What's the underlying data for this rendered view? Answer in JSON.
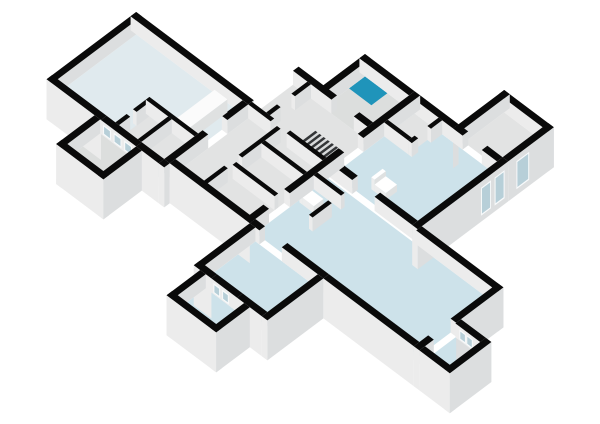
{
  "scene": {
    "kind": "3d-dollhouse-floor-plan",
    "canvas": {
      "width": 600,
      "height": 424
    },
    "background": "#ffffff"
  },
  "colors": {
    "background": "#ffffff",
    "wallTop": "#0a0a0a",
    "faceA": "#ececec",
    "faceB": "#dcdedf",
    "floorHall": "#e0eaee",
    "floorBlue": "#cde2ea",
    "floorGray": "#e2e3e3",
    "floorGray2": "#dcdedd",
    "teal": "#1f94ba",
    "glass": "#b7cfd8",
    "glassFrame": "#f8fafb",
    "counterTop": "#fbfbfb",
    "fixture": "#ffffff",
    "boxFaceA": "#eceded",
    "boxFaceB": "#dfe1e1",
    "stairBase": "#d8dadb",
    "stairStep": "#333537"
  },
  "projection": {
    "ax": 0.8,
    "ay": 0.6,
    "ox": 5,
    "oy": 10,
    "floor_z": 26,
    "wall_z": 40
  },
  "glass_z": {
    "e": [
      6,
      34
    ],
    "i": [
      27,
      37
    ]
  },
  "floors": [
    {
      "n": "floor-great-hall",
      "a": [
        -58,
        40
      ],
      "b": [
        124,
        257
      ],
      "c": "floorHall"
    },
    {
      "n": "floor-hall-storage",
      "a": [
        -58,
        -20
      ],
      "b": [
        200,
        257
      ],
      "c": "floorGray"
    },
    {
      "n": "floor-porch-left",
      "a": [
        -106,
        -65
      ],
      "b": [
        184,
        229
      ],
      "c": "floorGray2"
    },
    {
      "n": "floor-center-corridor",
      "a": [
        -51,
        96
      ],
      "b": [
        264,
        357
      ],
      "c": "floorGray"
    },
    {
      "n": "floor-bathroom",
      "a": [
        96,
        148
      ],
      "b": [
        302,
        357
      ],
      "c": "floorGray2"
    },
    {
      "n": "floor-shower-tray",
      "a": [
        128,
        148
      ],
      "b": [
        302,
        330
      ],
      "c": "teal"
    },
    {
      "n": "floor-room-right-mid",
      "a": [
        47,
        148
      ],
      "b": [
        364,
        467
      ],
      "c": "floorBlue"
    },
    {
      "n": "floor-right-store",
      "a": [
        114,
        148
      ],
      "b": [
        364,
        394
      ],
      "c": "floorGray"
    },
    {
      "n": "floor-room-top-right",
      "a": [
        155,
        205
      ],
      "b": [
        419,
        467
      ],
      "c": "floorGray"
    },
    {
      "n": "floor-room-bot-right",
      "a": [
        -51,
        40
      ],
      "b": [
        364,
        569
      ],
      "c": "floorBlue"
    },
    {
      "n": "floor-porch-right",
      "a": [
        -51,
        -13
      ],
      "b": [
        576,
        607
      ],
      "c": "floorBlue"
    },
    {
      "n": "floor-room-bot-left",
      "a": [
        -121,
        -58
      ],
      "b": [
        371,
        449
      ],
      "c": "floorBlue"
    },
    {
      "n": "floor-porch-west",
      "a": [
        -163,
        -128
      ],
      "b": [
        379,
        427
      ],
      "c": "floorBlue"
    }
  ],
  "walls": [
    {
      "n": "wall-hall-nw",
      "a": [
        -65,
        47
      ],
      "b": [
        117,
        124
      ],
      "fa": "g",
      "fb": "f"
    },
    {
      "n": "wall-hall-ne",
      "a": [
        40,
        47
      ],
      "b": [
        117,
        264
      ],
      "fa": "f",
      "fb": "f"
    },
    {
      "n": "wall-hall-sw-1",
      "a": [
        -65,
        -58
      ],
      "b": [
        117,
        185
      ],
      "fa": "g",
      "fb": "f"
    },
    {
      "n": "wall-hall-sw-glazed",
      "a": [
        -65,
        -58
      ],
      "b": [
        185,
        229
      ],
      "fa": "f",
      "fb": "f",
      "glass": {
        "face": "A",
        "z": "i",
        "spans": [
          [
            0.06,
            0.28
          ],
          [
            0.36,
            0.58
          ],
          [
            0.66,
            0.88
          ]
        ]
      }
    },
    {
      "n": "wall-hall-sw-2",
      "a": [
        -65,
        -58
      ],
      "b": [
        229,
        257
      ],
      "fa": "g",
      "fb": "f"
    },
    {
      "n": "wall-hall-se-1",
      "a": [
        -58,
        -10
      ],
      "b": [
        257,
        264
      ],
      "fa": "f",
      "fb": "f"
    },
    {
      "n": "wall-hall-se-2",
      "a": [
        14,
        40
      ],
      "b": [
        257,
        264
      ],
      "fa": "f",
      "fb": "f"
    },
    {
      "n": "wall-hall-se-corner",
      "a": [
        -65,
        -58
      ],
      "b": [
        257,
        264
      ],
      "fa": "g",
      "fb": "g"
    },
    {
      "n": "wall-porch-left-nw",
      "a": [
        -113,
        -65
      ],
      "b": [
        177,
        184
      ],
      "fa": "g",
      "fb": "f"
    },
    {
      "n": "wall-porch-left-sw",
      "a": [
        -113,
        -106
      ],
      "b": [
        177,
        236
      ],
      "fa": "g",
      "fb": "g"
    },
    {
      "n": "wall-porch-left-se",
      "a": [
        -113,
        -65
      ],
      "b": [
        229,
        236
      ],
      "fa": "g",
      "fb": "g"
    },
    {
      "n": "wall-center-ne-1",
      "a": [
        96,
        103
      ],
      "b": [
        264,
        298
      ],
      "fa": "f",
      "fb": "f"
    },
    {
      "n": "wall-center-ne-2",
      "a": [
        96,
        103
      ],
      "b": [
        298,
        312
      ],
      "fa": "f",
      "fb": "f"
    },
    {
      "n": "wall-center-ne-3",
      "a": [
        96,
        103
      ],
      "b": [
        340,
        357
      ],
      "fa": "f",
      "fb": "f"
    },
    {
      "n": "wall-center-sw",
      "a": [
        -58,
        -51
      ],
      "b": [
        264,
        364
      ],
      "fa": "g",
      "fb": "f"
    },
    {
      "n": "wall-mid-bound-1",
      "a": [
        -58,
        -34
      ],
      "b": [
        357,
        364
      ],
      "fa": "f",
      "fb": "f"
    },
    {
      "n": "wall-mid-bound-2",
      "a": [
        -8,
        60
      ],
      "b": [
        357,
        364
      ],
      "fa": "f",
      "fb": "f"
    },
    {
      "n": "wall-mid-bound-3",
      "a": [
        84,
        155
      ],
      "b": [
        357,
        364
      ],
      "fa": "f",
      "fb": "f"
    },
    {
      "n": "wall-bath-nw",
      "a": [
        96,
        155
      ],
      "b": [
        295,
        302
      ],
      "fa": "f",
      "fb": "f"
    },
    {
      "n": "wall-bath-ne",
      "a": [
        148,
        155
      ],
      "b": [
        295,
        357
      ],
      "fa": "f",
      "fb": "f"
    },
    {
      "n": "wall-rightmid-w-1",
      "a": [
        42,
        49
      ],
      "b": [
        364,
        392
      ],
      "fa": "f",
      "fb": "f"
    },
    {
      "n": "wall-rightmid-w-2",
      "a": [
        42,
        49
      ],
      "b": [
        420,
        467
      ],
      "fa": "f",
      "fb": "f"
    },
    {
      "n": "wall-rightmid-se-glazed",
      "a": [
        42,
        155
      ],
      "b": [
        467,
        474
      ],
      "fa": "g",
      "fb": "g",
      "glass": {
        "face": "B",
        "z": "e",
        "spans": [
          [
            0.7,
            0.81
          ],
          [
            0.85,
            0.96
          ]
        ]
      }
    },
    {
      "n": "wall-rightmid-ne-1",
      "a": [
        148,
        155
      ],
      "b": [
        364,
        412
      ],
      "fa": "f",
      "fb": "g"
    },
    {
      "n": "wall-rightmid-ne-2",
      "a": [
        148,
        155
      ],
      "b": [
        412,
        424
      ],
      "fa": "f",
      "fb": "f"
    },
    {
      "n": "wall-rightmid-ne-3",
      "a": [
        148,
        155
      ],
      "b": [
        448,
        467
      ],
      "fa": "f",
      "fb": "f"
    },
    {
      "n": "wall-right-store-w",
      "a": [
        110,
        114.5
      ],
      "b": [
        364,
        394
      ],
      "fa": "f",
      "fb": "f"
    },
    {
      "n": "wall-right-store-s1",
      "a": [
        110,
        118
      ],
      "b": [
        394,
        398.5
      ],
      "fa": "f",
      "fb": "f"
    },
    {
      "n": "wall-right-store-s2",
      "a": [
        134,
        148
      ],
      "b": [
        394,
        398.5
      ],
      "fa": "f",
      "fb": "f"
    },
    {
      "n": "wall-topright-nw",
      "a": [
        148,
        212
      ],
      "b": [
        412,
        419
      ],
      "fa": "f",
      "fb": "f"
    },
    {
      "n": "wall-topright-ne",
      "a": [
        205,
        212
      ],
      "b": [
        412,
        474
      ],
      "fa": "f",
      "fb": "g"
    },
    {
      "n": "wall-topright-se-glazed",
      "a": [
        155,
        212
      ],
      "b": [
        467,
        474
      ],
      "fa": "f",
      "fb": "g",
      "glass": {
        "face": "B",
        "z": "e",
        "spans": [
          [
            0.18,
            0.46
          ]
        ]
      }
    },
    {
      "n": "wall-botright-e",
      "a": [
        40,
        47
      ],
      "b": [
        474,
        576
      ],
      "fa": "f",
      "fb": "g"
    },
    {
      "n": "wall-botright-w-1",
      "a": [
        -58,
        -51
      ],
      "b": [
        364,
        376
      ],
      "fa": "f",
      "fb": "f"
    },
    {
      "n": "wall-botright-w-2",
      "a": [
        -58,
        -51
      ],
      "b": [
        404,
        456
      ],
      "fa": "f",
      "fb": "f"
    },
    {
      "n": "wall-botright-w-3",
      "a": [
        -58,
        -51
      ],
      "b": [
        456,
        569
      ],
      "fa": "g",
      "fb": "f"
    },
    {
      "n": "wall-botright-s-1",
      "a": [
        -58,
        -40
      ],
      "b": [
        569,
        576
      ],
      "fa": "g",
      "fb": "f"
    },
    {
      "n": "wall-botright-s-2",
      "a": [
        -12,
        47
      ],
      "b": [
        569,
        576
      ],
      "fa": "f",
      "fb": "g"
    },
    {
      "n": "wall-wc-e",
      "a": [
        22,
        26.5
      ],
      "b": [
        364,
        398
      ],
      "fa": "f",
      "fb": "f"
    },
    {
      "n": "wall-wc-s",
      "a": [
        -14,
        10
      ],
      "b": [
        394,
        398.5
      ],
      "fa": "f",
      "fb": "f"
    },
    {
      "n": "wall-porch-right-sw",
      "a": [
        -58,
        -51
      ],
      "b": [
        576,
        614
      ],
      "fa": "g",
      "fb": "g"
    },
    {
      "n": "wall-porch-right-se",
      "a": [
        -58,
        -6
      ],
      "b": [
        607,
        614
      ],
      "fa": "g",
      "fb": "g"
    },
    {
      "n": "wall-porch-right-glazed",
      "a": [
        -13,
        -6
      ],
      "b": [
        576,
        607
      ],
      "fa": "f",
      "fb": "g",
      "glass": {
        "face": "A",
        "z": "i",
        "spans": [
          [
            0.16,
            0.42
          ],
          [
            0.44,
            0.7
          ]
        ]
      }
    },
    {
      "n": "wall-botleft-nw",
      "a": [
        -128,
        -58
      ],
      "b": [
        364,
        371
      ],
      "fa": "g",
      "fb": "f"
    },
    {
      "n": "wall-botleft-w-1",
      "a": [
        -128,
        -121
      ],
      "b": [
        364,
        386
      ],
      "fa": "g",
      "fb": "f"
    },
    {
      "n": "wall-botleft-w-glazed",
      "a": [
        -128,
        -121
      ],
      "b": [
        386,
        418
      ],
      "fa": "f",
      "fb": "f",
      "glass": {
        "face": "A",
        "z": "i",
        "spans": [
          [
            0.08,
            0.34
          ],
          [
            0.42,
            0.68
          ]
        ]
      }
    },
    {
      "n": "wall-botleft-w-2",
      "a": [
        -128,
        -121
      ],
      "b": [
        418,
        449
      ],
      "fa": "g",
      "fb": "f"
    },
    {
      "n": "wall-botleft-se",
      "a": [
        -128,
        -58
      ],
      "b": [
        449,
        456
      ],
      "fa": "g",
      "fb": "g"
    },
    {
      "n": "wall-porch-west-nw",
      "a": [
        -170,
        -128
      ],
      "b": [
        372,
        379
      ],
      "fa": "g",
      "fb": "f"
    },
    {
      "n": "wall-porch-west-sw",
      "a": [
        -170,
        -163
      ],
      "b": [
        372,
        434
      ],
      "fa": "g",
      "fb": "g"
    },
    {
      "n": "wall-porch-west-se",
      "a": [
        -170,
        -128
      ],
      "b": [
        427,
        434
      ],
      "fa": "g",
      "fb": "g"
    },
    {
      "n": "wall-corridor-s1",
      "a": [
        -58,
        -26
      ],
      "b": [
        300,
        304.5
      ],
      "fa": "f",
      "fb": "f"
    },
    {
      "n": "wall-corridor-s2",
      "a": [
        -8,
        40
      ],
      "b": [
        300,
        304.5
      ],
      "fa": "f",
      "fb": "f"
    },
    {
      "n": "wall-center-room-w",
      "a": [
        -20,
        -15.5
      ],
      "b": [
        304.5,
        357
      ],
      "fa": "f",
      "fb": "f"
    },
    {
      "n": "wall-center-room-e",
      "a": [
        16,
        20.5
      ],
      "b": [
        304.5,
        357
      ],
      "fa": "f",
      "fb": "f"
    },
    {
      "n": "wall-center-e-1",
      "a": [
        40,
        44.5
      ],
      "b": [
        264,
        292
      ],
      "fa": "f",
      "fb": "f"
    },
    {
      "n": "wall-center-e-2",
      "a": [
        40,
        44.5
      ],
      "b": [
        312,
        357
      ],
      "fa": "f",
      "fb": "f"
    },
    {
      "n": "wall-center-ne-room-s1",
      "a": [
        44.5,
        58
      ],
      "b": [
        282,
        286.5
      ],
      "fa": "f",
      "fb": "f"
    },
    {
      "n": "wall-center-ne-room-s2",
      "a": [
        76,
        96
      ],
      "b": [
        282,
        286.5
      ],
      "fa": "f",
      "fb": "f"
    },
    {
      "n": "wall-hall-closet-w",
      "a": [
        -20,
        -15.5
      ],
      "b": [
        196,
        257
      ],
      "fa": "f",
      "fb": "f"
    },
    {
      "n": "wall-hall-closet-n1",
      "a": [
        -58,
        -44
      ],
      "b": [
        196,
        200.5
      ],
      "fa": "f",
      "fb": "f"
    },
    {
      "n": "wall-hall-closet-n2",
      "a": [
        -36,
        -20
      ],
      "b": [
        196,
        200.5
      ],
      "fa": "f",
      "fb": "f"
    },
    {
      "n": "wall-hall-closet-mid",
      "a": [
        -58,
        -20
      ],
      "b": [
        224,
        228.5
      ],
      "fa": "f",
      "fb": "f"
    }
  ],
  "boxes": [
    {
      "n": "kitchen-counter",
      "a": [
        -16,
        32
      ],
      "b": [
        230,
        246
      ],
      "z": [
        26,
        39
      ],
      "top": "counterTop"
    },
    {
      "n": "toilet-tank-center",
      "a": [
        2,
        14
      ],
      "b": [
        366,
        370
      ],
      "z": [
        26,
        38
      ],
      "top": "fixture"
    },
    {
      "n": "toilet-body-center",
      "a": [
        2,
        14
      ],
      "b": [
        370,
        384
      ],
      "z": [
        26,
        33
      ],
      "top": "fixture"
    },
    {
      "n": "toilet-tank-right",
      "a": [
        58,
        72
      ],
      "b": [
        400,
        404
      ],
      "z": [
        26,
        38
      ],
      "top": "fixture"
    },
    {
      "n": "toilet-body-right",
      "a": [
        58,
        72
      ],
      "b": [
        404,
        418
      ],
      "z": [
        26,
        33
      ],
      "top": "fixture"
    }
  ],
  "stairs": {
    "n": "staircase",
    "a": [
      48,
      70
    ],
    "b": [
      318,
      354
    ],
    "steps": 7,
    "step_width": 2.6
  }
}
